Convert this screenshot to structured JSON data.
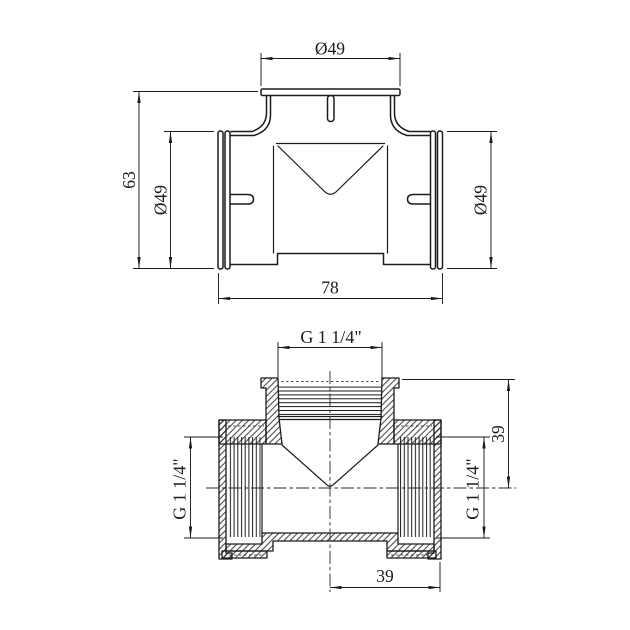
{
  "colors": {
    "background": "#ffffff",
    "ink": "#1b1b1b"
  },
  "views": {
    "front": {
      "dim_top_diameter": "Ø49",
      "dim_height": "63",
      "dim_left_diameter": "Ø49",
      "dim_right_diameter": "Ø49",
      "dim_width": "78"
    },
    "section": {
      "dim_top_thread": "G 1 1/4\"",
      "dim_left_thread": "G 1 1/4\"",
      "dim_right_thread": "G 1 1/4\"",
      "dim_right_offset": "39",
      "dim_bottom_offset": "39"
    }
  }
}
